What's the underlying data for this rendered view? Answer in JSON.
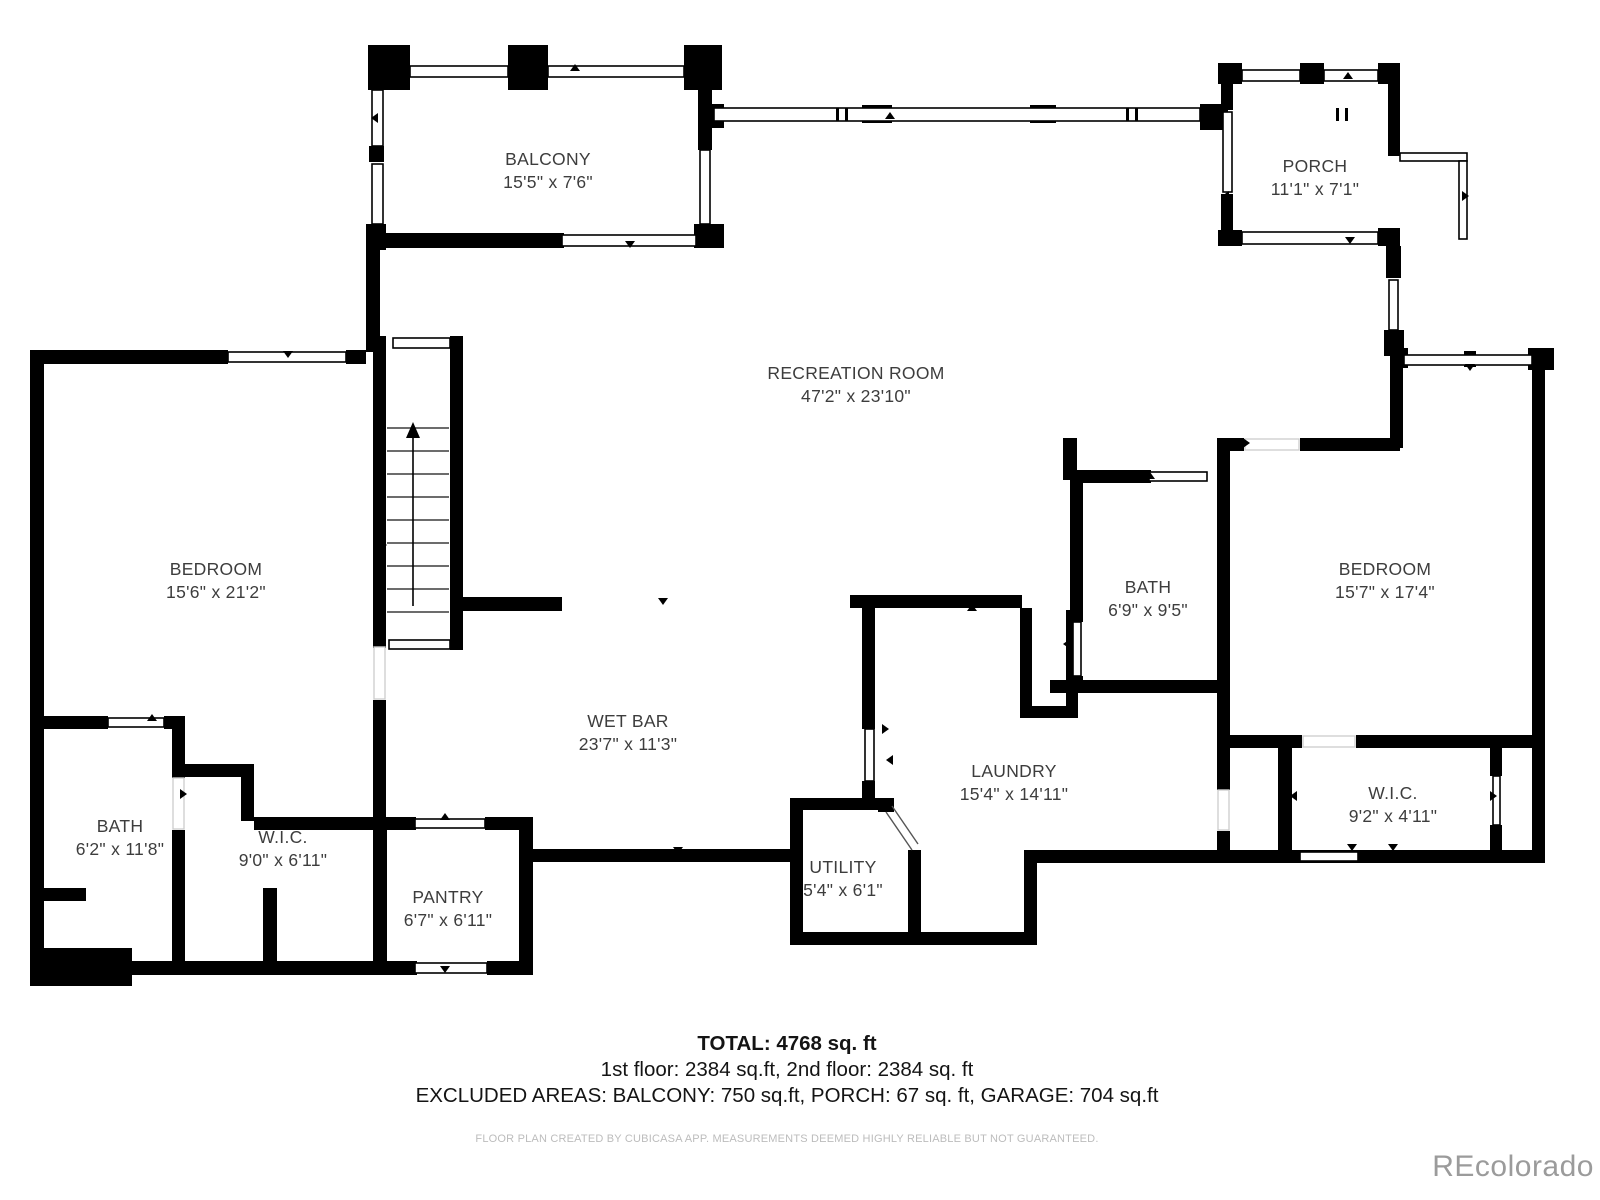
{
  "rooms": [
    {
      "name": "BALCONY",
      "dims": "15'5\" x 7'6\""
    },
    {
      "name": "PORCH",
      "dims": "11'1\" x 7'1\""
    },
    {
      "name": "RECREATION ROOM",
      "dims": "47'2\" x 23'10\""
    },
    {
      "name": "BEDROOM",
      "dims": "15'6\" x 21'2\""
    },
    {
      "name": "BATH",
      "dims": "6'9\" x 9'5\""
    },
    {
      "name": "BEDROOM",
      "dims": "15'7\" x 17'4\""
    },
    {
      "name": "WET BAR",
      "dims": "23'7\" x 11'3\""
    },
    {
      "name": "LAUNDRY",
      "dims": "15'4\" x 14'11\""
    },
    {
      "name": "BATH",
      "dims": "6'2\" x 11'8\""
    },
    {
      "name": "W.I.C.",
      "dims": "9'0\" x 6'11\""
    },
    {
      "name": "PANTRY",
      "dims": "6'7\" x 6'11\""
    },
    {
      "name": "UTILITY",
      "dims": "5'4\" x 6'1\""
    },
    {
      "name": "W.I.C.",
      "dims": "9'2\" x 4'11\""
    }
  ],
  "summary": {
    "total_line": "TOTAL: 4768 sq. ft",
    "floors_line": "1st floor: 2384 sq.ft, 2nd floor: 2384 sq. ft",
    "excluded_line": "EXCLUDED AREAS: BALCONY: 750 sq.ft, PORCH: 67 sq. ft, GARAGE: 704 sq.ft"
  },
  "footer": {
    "disclaimer": "FLOOR PLAN CREATED BY CUBICASA APP. MEASUREMENTS DEEMED HIGHLY RELIABLE BUT NOT GUARANTEED."
  },
  "watermark": "REcolorado",
  "colors": {
    "walls": "#000000",
    "label_text": "#3d3d3d",
    "fine_print": "#bcbcbc",
    "watermark": "#9b9b9b",
    "background": "#ffffff"
  }
}
